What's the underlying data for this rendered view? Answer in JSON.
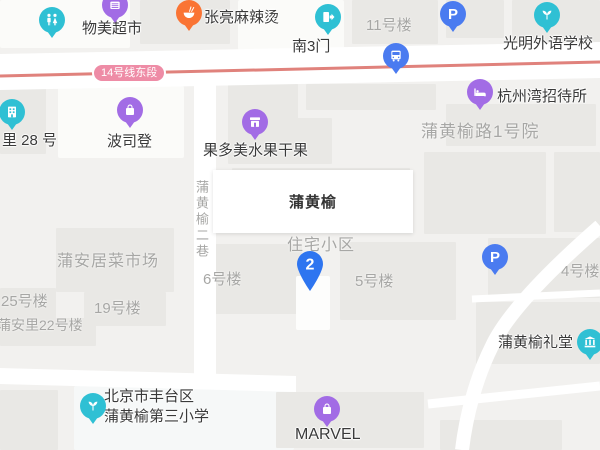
{
  "map": {
    "popup": {
      "title": "蒲黄榆"
    },
    "marker": {
      "number": "2"
    },
    "metro": {
      "label": "14号线东段"
    },
    "pois": {
      "wumart": "物美超市",
      "zhangliang": "张亮麻辣烫",
      "south_gate3": "南3门",
      "guangming_school": "光明外语学校",
      "hangzhouwan_hostel": "杭州湾招待所",
      "li28": "里 28 号",
      "bosideng": "波司登",
      "guoduomei": "果多美水果干果",
      "parking_letter": "P",
      "hall": "蒲黄榆礼堂",
      "school_line1": "北京市丰台区",
      "school_line2": "蒲黄榆第三小学",
      "marvel": "MARVEL"
    },
    "areas": {
      "building11": "11号楼",
      "yard1": "蒲黄榆路1号院",
      "residential": "住宅小区",
      "building6": "6号楼",
      "building5": "5号楼",
      "building4": "4号楼",
      "market": "蒲安居菜市场",
      "building19": "19号楼",
      "building25": "25号楼",
      "puanli22": "蒲安里22号楼",
      "lane": "蒲黄榆二巷"
    },
    "colors": {
      "teal": "#2fc0d4",
      "purple": "#a26ce5",
      "orange": "#fa7434",
      "blue": "#4a7bf0",
      "marker_blue": "#2e75f0",
      "metro_line": "#e0827c",
      "metro_badge": "#ee8ca6"
    }
  }
}
